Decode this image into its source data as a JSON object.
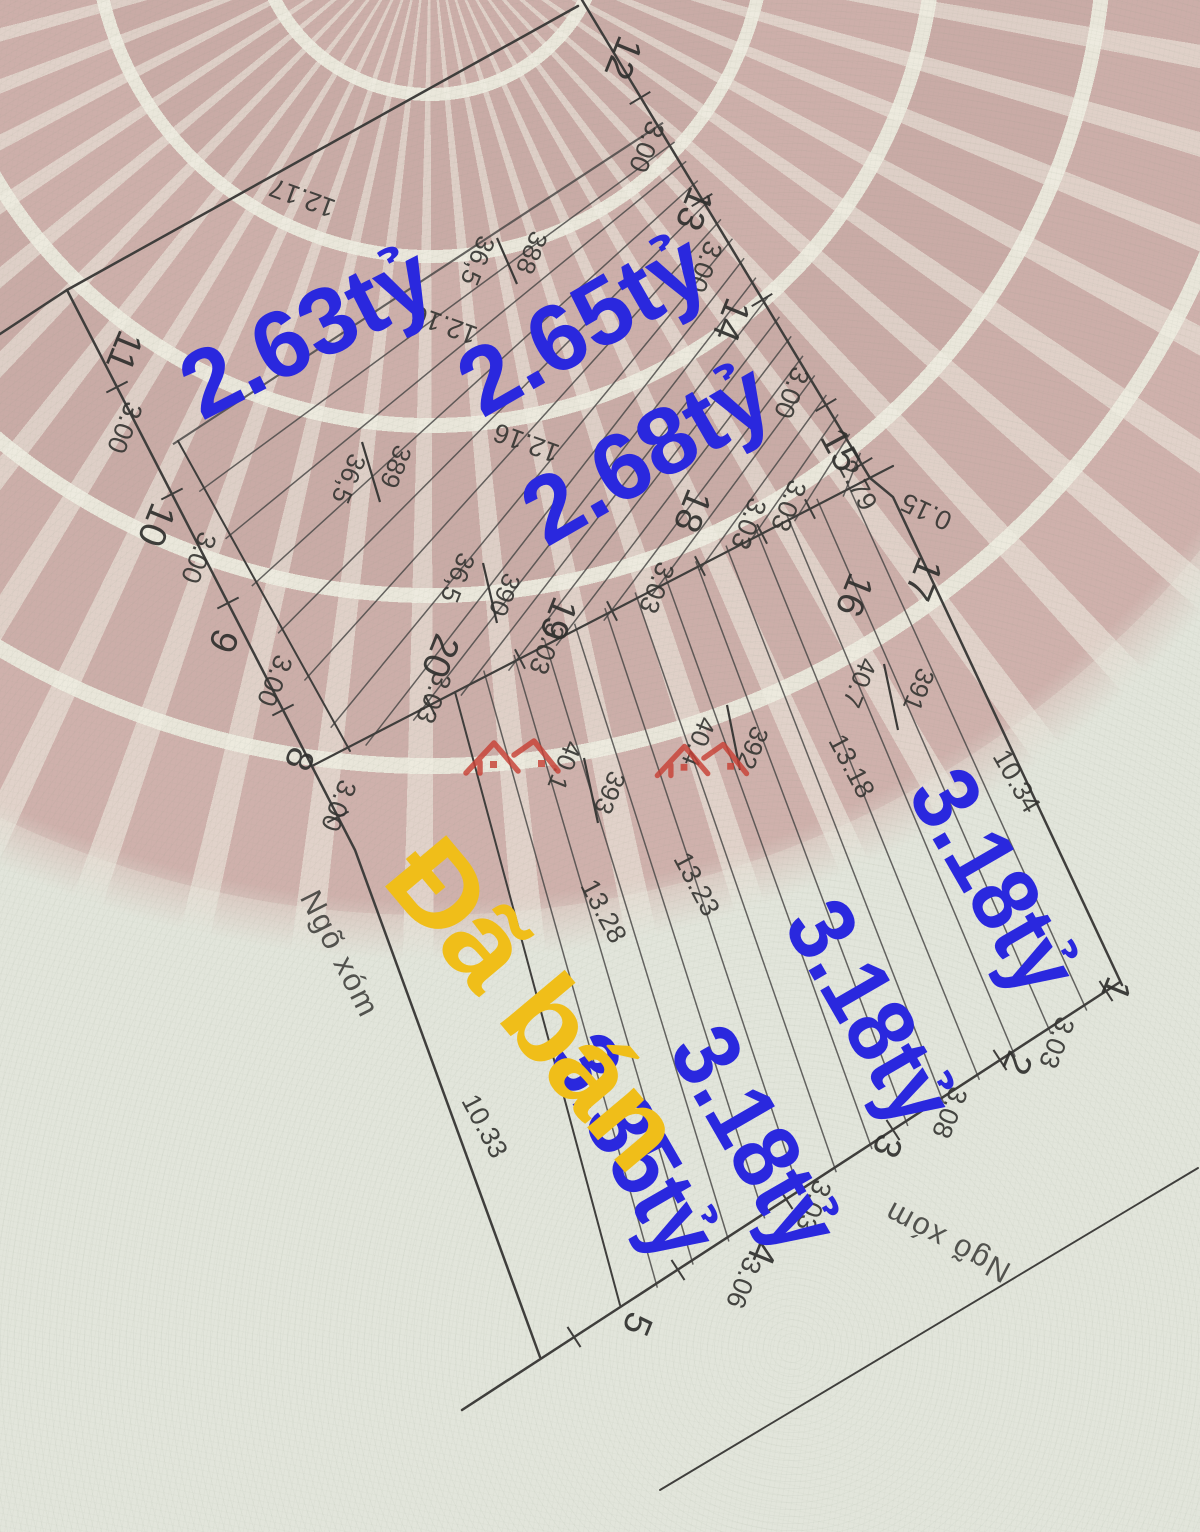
{
  "meta": {
    "description": "Vietnamese cadastral land-plot subdivision sketch over Dong Son drum patterned paper, with handwritten-style price overlays",
    "canvas": {
      "width": 1200,
      "height": 1532
    }
  },
  "colors": {
    "price_blue": "#2a28de",
    "sold_yellow": "#f0be19",
    "line_dark": "#3f3e3c",
    "logo_red": "#c84136"
  },
  "labels": {
    "plot_numbers": [
      {
        "t": "12",
        "x": 621,
        "y": 57,
        "r": 112
      },
      {
        "t": "13",
        "x": 692,
        "y": 208,
        "r": 112
      },
      {
        "t": "14",
        "x": 729,
        "y": 319,
        "r": 112
      },
      {
        "t": "15",
        "x": 838,
        "y": 451,
        "r": 62
      },
      {
        "t": "11",
        "x": 122,
        "y": 350,
        "r": 112
      },
      {
        "t": "10",
        "x": 154,
        "y": 524,
        "r": 112
      },
      {
        "t": "9",
        "x": 221,
        "y": 640,
        "r": 112
      },
      {
        "t": "8",
        "x": 297,
        "y": 758,
        "r": 112
      },
      {
        "t": "16",
        "x": 852,
        "y": 594,
        "r": 112
      },
      {
        "t": "17",
        "x": 921,
        "y": 578,
        "r": 112
      },
      {
        "t": "18",
        "x": 690,
        "y": 510,
        "r": 112
      },
      {
        "t": "19",
        "x": 556,
        "y": 618,
        "r": 112
      },
      {
        "t": "20",
        "x": 438,
        "y": 655,
        "r": 112
      },
      {
        "t": "1",
        "x": 1114,
        "y": 988,
        "r": 112
      },
      {
        "t": "2",
        "x": 1015,
        "y": 1062,
        "r": 112
      },
      {
        "t": "3",
        "x": 885,
        "y": 1145,
        "r": 112
      },
      {
        "t": "4",
        "x": 760,
        "y": 1252,
        "r": 112
      },
      {
        "t": "5",
        "x": 635,
        "y": 1323,
        "r": 112
      }
    ],
    "dimensions": [
      {
        "t": "3.00",
        "x": 645,
        "y": 146,
        "r": 112
      },
      {
        "t": "3.00",
        "x": 703,
        "y": 266,
        "r": 112
      },
      {
        "t": "3.00",
        "x": 790,
        "y": 392,
        "r": 112
      },
      {
        "t": "3.00",
        "x": 123,
        "y": 427,
        "r": 112
      },
      {
        "t": "3.00",
        "x": 197,
        "y": 557,
        "r": 112
      },
      {
        "t": "3.00",
        "x": 273,
        "y": 680,
        "r": 112
      },
      {
        "t": "3.00",
        "x": 337,
        "y": 805,
        "r": 112
      },
      {
        "t": "3.03",
        "x": 787,
        "y": 505,
        "r": 112
      },
      {
        "t": "3.03",
        "x": 747,
        "y": 523,
        "r": 112
      },
      {
        "t": "3.03",
        "x": 655,
        "y": 587,
        "r": 112
      },
      {
        "t": "3.03",
        "x": 545,
        "y": 648,
        "r": 112
      },
      {
        "t": "3.03",
        "x": 432,
        "y": 697,
        "r": 112
      },
      {
        "t": "3.03",
        "x": 1055,
        "y": 1042,
        "r": 112
      },
      {
        "t": "3.08",
        "x": 948,
        "y": 1112,
        "r": 112
      },
      {
        "t": "3.03",
        "x": 812,
        "y": 1205,
        "r": 112
      },
      {
        "t": "3.06",
        "x": 742,
        "y": 1282,
        "r": 112
      },
      {
        "t": "2.79",
        "x": 856,
        "y": 486,
        "r": 62
      },
      {
        "t": "0.15",
        "x": 927,
        "y": 510,
        "r": 205
      }
    ],
    "lengths": [
      {
        "t": "12.17",
        "x": 303,
        "y": 196,
        "r": 200
      },
      {
        "t": "12.16",
        "x": 445,
        "y": 323,
        "r": 200
      },
      {
        "t": "12.16",
        "x": 527,
        "y": 441,
        "r": 200
      },
      {
        "t": "13.18",
        "x": 850,
        "y": 767,
        "r": 62
      },
      {
        "t": "13.23",
        "x": 695,
        "y": 885,
        "r": 62
      },
      {
        "t": "13.28",
        "x": 602,
        "y": 912,
        "r": 62
      },
      {
        "t": "10.33",
        "x": 483,
        "y": 1127,
        "r": 62
      },
      {
        "t": "10.34",
        "x": 1015,
        "y": 782,
        "r": 60
      }
    ],
    "parcels": [
      {
        "id": "388",
        "area": "36,5",
        "idx": 530,
        "idy": 252,
        "ax": 476,
        "ay": 260,
        "r": 112,
        "bar": [
          497,
          238,
          517,
          284
        ]
      },
      {
        "id": "389",
        "area": "36,5",
        "idx": 394,
        "idy": 466,
        "ax": 347,
        "ay": 478,
        "r": 112,
        "bar": [
          362,
          442,
          380,
          502
        ]
      },
      {
        "id": "390",
        "area": "36,5",
        "idx": 503,
        "idy": 594,
        "ax": 456,
        "ay": 577,
        "r": 112,
        "bar": [
          483,
          563,
          497,
          623
        ]
      },
      {
        "id": "391",
        "area": "40.7",
        "idx": 917,
        "idy": 689,
        "ax": 858,
        "ay": 682,
        "r": 112,
        "bar": [
          884,
          664,
          898,
          730
        ]
      },
      {
        "id": "392",
        "area": "40.4",
        "idx": 751,
        "idy": 747,
        "ax": 697,
        "ay": 741,
        "r": 112,
        "bar": [
          727,
          705,
          740,
          770
        ]
      },
      {
        "id": "393",
        "area": "40.1",
        "idx": 608,
        "idy": 792,
        "ax": 563,
        "ay": 765,
        "r": 112,
        "bar": [
          584,
          758,
          598,
          823
        ]
      }
    ],
    "roads": [
      {
        "t": "Ngõ xóm",
        "x": 338,
        "y": 955,
        "r": 63
      },
      {
        "t": "Ngõ xóm",
        "x": 948,
        "y": 1240,
        "r": 208
      }
    ],
    "prices": [
      {
        "t": "2.63tỷ",
        "x": 310,
        "y": 338,
        "r": -27,
        "tl": 268
      },
      {
        "t": "2.65tỷ",
        "x": 586,
        "y": 330,
        "r": -30,
        "tl": 268
      },
      {
        "t": "2.68tỷ",
        "x": 650,
        "y": 459,
        "r": -30,
        "tl": 268
      },
      {
        "t": "3.18tỷ",
        "x": 988,
        "y": 885,
        "r": 60,
        "tl": 240
      },
      {
        "t": "3.18tỷ",
        "x": 864,
        "y": 1016,
        "r": 60,
        "tl": 240
      },
      {
        "t": "3.18tỷ",
        "x": 749,
        "y": 1142,
        "r": 60,
        "tl": 240
      },
      {
        "t": "3.35tỷ",
        "x": 628,
        "y": 1150,
        "r": 60,
        "tl": 240
      }
    ],
    "sold": {
      "t": "Đã bán",
      "x": 527,
      "y": 1008,
      "r": 50,
      "tl": 385
    }
  }
}
